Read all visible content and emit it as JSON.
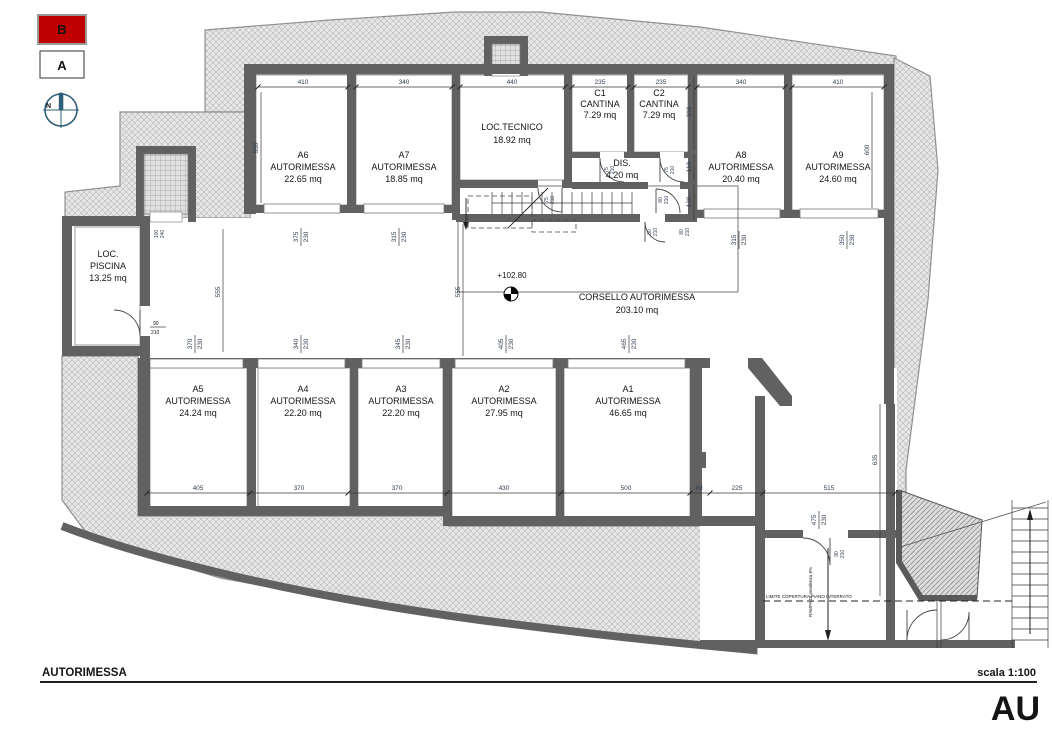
{
  "legend": {
    "marker_b": "B",
    "marker_a": "A",
    "north": "N"
  },
  "rooms": {
    "a6": {
      "id": "A6",
      "type": "AUTORIMESSA",
      "area": "22.65 mq"
    },
    "a7": {
      "id": "A7",
      "type": "AUTORIMESSA",
      "area": "18.85 mq"
    },
    "tecnico": {
      "name": "LOC.TECNICO",
      "area": "18.92 mq"
    },
    "c1": {
      "id": "C1",
      "type": "CANTINA",
      "area": "7.29 mq"
    },
    "c2": {
      "id": "C2",
      "type": "CANTINA",
      "area": "7.29 mq"
    },
    "dis": {
      "name": "DIS.",
      "area": "4.20 mq"
    },
    "a8": {
      "id": "A8",
      "type": "AUTORIMESSA",
      "area": "20.40 mq"
    },
    "a9": {
      "id": "A9",
      "type": "AUTORIMESSA",
      "area": "24.60 mq"
    },
    "piscina": {
      "line1": "LOC.",
      "line2": "PISCINA",
      "area": "13.25 mq"
    },
    "corsello": {
      "name": "CORSELLO AUTORIMESSA",
      "area": "203.10 mq"
    },
    "a5": {
      "id": "A5",
      "type": "AUTORIMESSA",
      "area": "24.24 mq"
    },
    "a4": {
      "id": "A4",
      "type": "AUTORIMESSA",
      "area": "22.20 mq"
    },
    "a3": {
      "id": "A3",
      "type": "AUTORIMESSA",
      "area": "22.20 mq"
    },
    "a2": {
      "id": "A2",
      "type": "AUTORIMESSA",
      "area": "27.95 mq"
    },
    "a1": {
      "id": "A1",
      "type": "AUTORIMESSA",
      "area": "46.65 mq"
    }
  },
  "level_marker": "+102.80",
  "dims": {
    "top": [
      "410",
      "340",
      "440",
      "235",
      "235",
      "340",
      "410"
    ],
    "bottom": [
      "405",
      "370",
      "370",
      "430",
      "500",
      "80",
      "225",
      "515"
    ],
    "vertical": {
      "a6": "555",
      "a9": "600",
      "corsello": "555",
      "piscina": "555",
      "ramp": "635",
      "c2_side": "310",
      "dis_side": "110",
      "stair_side": "120"
    },
    "garage": {
      "a6": {
        "w": "375",
        "h": "230"
      },
      "a7": {
        "w": "315",
        "h": "230"
      },
      "a8": {
        "w": "315",
        "h": "230"
      },
      "a9": {
        "w": "350",
        "h": "230"
      },
      "a5": {
        "w": "370",
        "h": "230"
      },
      "a4": {
        "w": "340",
        "h": "230"
      },
      "a3": {
        "w": "345",
        "h": "230"
      },
      "a2": {
        "w": "405",
        "h": "230"
      },
      "a1": {
        "w": "465",
        "h": "230"
      },
      "ramp": {
        "w": "475",
        "h": "230"
      }
    },
    "doors": {
      "tecnico": {
        "w": "75",
        "h": "210"
      },
      "c1": {
        "w": "75",
        "h": "210"
      },
      "c2": {
        "w": "75",
        "h": "210"
      },
      "dis": {
        "w": "80",
        "h": "210"
      },
      "stair_a": {
        "w": "80",
        "h": "210"
      },
      "stair_b": {
        "w": "80",
        "h": "210"
      },
      "piscina": {
        "w": "90",
        "h": "210"
      },
      "lift": {
        "w": "100",
        "h": "240"
      },
      "ramp": {
        "w": "90",
        "h": "210"
      }
    }
  },
  "annotations": {
    "limit_line": "LIMITE COPERTURA PIANO INTERRATO",
    "ramp_note": "RAMPA DI pendenza 8%"
  },
  "title_block": {
    "drawing_title": "AUTORIMESSA",
    "scale": "scala 1:100",
    "sheet_code": "AU"
  },
  "colors": {
    "marker_b_fill": "#c00000",
    "wall": "#616161",
    "compass": "#2e5f78"
  }
}
